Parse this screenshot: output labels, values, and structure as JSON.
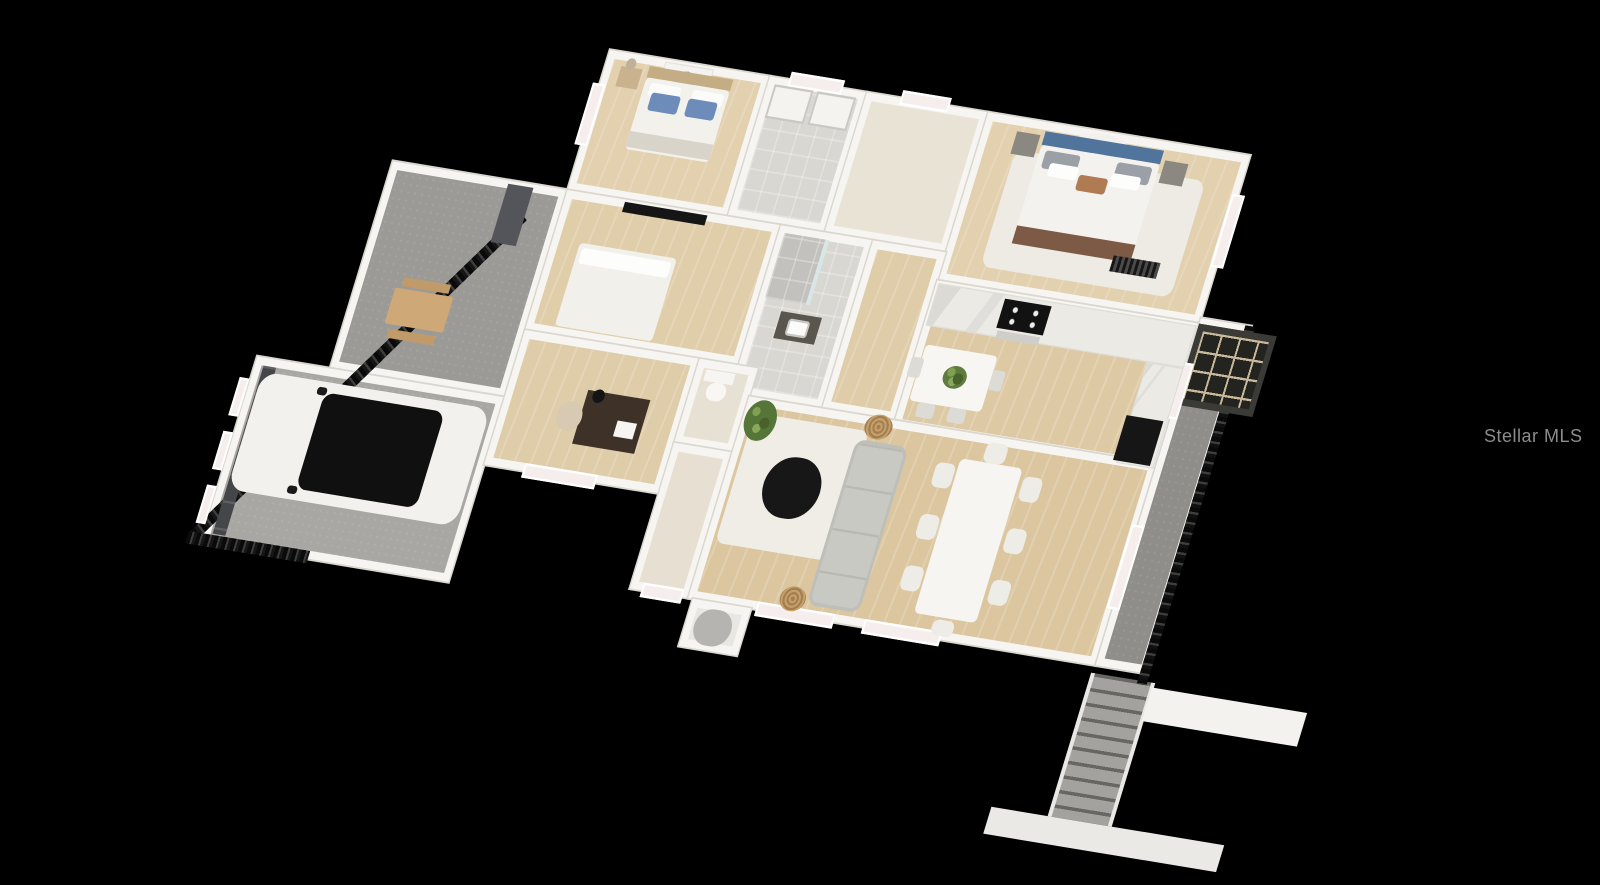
{
  "watermark": {
    "text": "Stellar MLS",
    "color": "#8d8d8d"
  },
  "scene": {
    "background": "#000000",
    "description": "3D dollhouse-view floor plan render of a single-story home",
    "plan": {
      "left": 610,
      "top": 50,
      "transform": "matrix(0.97, 0.16, -0.34, 1.12, 0, 0)"
    }
  },
  "palette": {
    "wall_white": "#f6f5f1",
    "wood_floor": "#ddc9a3",
    "tile_floor": "#d8d7d1",
    "cream_floor": "#e9e3d6",
    "concrete": "#a3a29e",
    "accent_pillow_blue": "#6d8cba",
    "headboard_blue": "#50749c",
    "appliance_black": "#141414",
    "fence_black": "#161616",
    "watermark_gray": "#8d8d8d"
  },
  "boxes": [
    {
      "name": "patio",
      "x": -180,
      "y": 125,
      "w": 180,
      "h": 185,
      "bg": "#9b9a96",
      "cls": "room concrete"
    },
    {
      "name": "garage",
      "x": -255,
      "y": 310,
      "w": 255,
      "h": 165,
      "bg": "#a8a7a3",
      "cls": "room concrete"
    },
    {
      "name": "bedroom-1",
      "x": 0,
      "y": 0,
      "w": 165,
      "h": 125,
      "bg": "#e2d0ae",
      "cls": "room wood"
    },
    {
      "name": "laundry-room",
      "x": 165,
      "y": 0,
      "w": 100,
      "h": 125,
      "bg": "#d8d7d1",
      "cls": "room tilef"
    },
    {
      "name": "closet-hall",
      "x": 265,
      "y": 0,
      "w": 125,
      "h": 125,
      "bg": "#e9e3d6",
      "cls": "room"
    },
    {
      "name": "primary-bedroom",
      "x": 390,
      "y": 0,
      "w": 270,
      "h": 150,
      "bg": "#e2d0ae",
      "cls": "room wood"
    },
    {
      "name": "bedroom-2",
      "x": 0,
      "y": 125,
      "w": 220,
      "h": 125,
      "bg": "#e0cda9",
      "cls": "room wood"
    },
    {
      "name": "bathroom",
      "x": 220,
      "y": 125,
      "w": 95,
      "h": 150,
      "bg": "#d8d7d1",
      "cls": "room tilef"
    },
    {
      "name": "hallway",
      "x": 315,
      "y": 125,
      "w": 75,
      "h": 150,
      "bg": "#dfcca8",
      "cls": "room wood"
    },
    {
      "name": "kitchen",
      "x": 390,
      "y": 150,
      "w": 270,
      "h": 130,
      "bg": "#ddc9a3",
      "cls": "room wood"
    },
    {
      "name": "office",
      "x": 0,
      "y": 250,
      "w": 180,
      "h": 120,
      "bg": "#dfcca8",
      "cls": "room wood"
    },
    {
      "name": "powder-room",
      "x": 180,
      "y": 250,
      "w": 60,
      "h": 75,
      "bg": "#e7e1d4",
      "cls": "room"
    },
    {
      "name": "foyer",
      "x": 180,
      "y": 325,
      "w": 60,
      "h": 130,
      "bg": "#e7e0d2",
      "cls": "room"
    },
    {
      "name": "living-room",
      "x": 240,
      "y": 275,
      "w": 420,
      "h": 180,
      "bg": "#dbc69f",
      "cls": "room wood"
    },
    {
      "name": "entry-porch",
      "x": 245,
      "y": 455,
      "w": 60,
      "h": 42,
      "bg": "#e8e7e2",
      "cls": "room"
    },
    {
      "name": "lanai",
      "x": 660,
      "y": 145,
      "w": 52,
      "h": 310,
      "bg": "#8f8e8a",
      "cls": "room concrete"
    },
    {
      "name": "stair-well",
      "x": 658,
      "y": 462,
      "w": 66,
      "h": 128,
      "bg": "#a3a29e",
      "cls": "stairs"
    },
    {
      "name": "yard-fence",
      "x": -40,
      "y": 150,
      "w": 11,
      "h": 394,
      "rot": 35.7,
      "bg": "#161616",
      "cls": "fence"
    },
    {
      "name": "yard-fence-corner",
      "x": -270,
      "y": 468,
      "w": 125,
      "h": 11,
      "bg": "#161616",
      "cls": "fence-h"
    },
    {
      "name": "patio-column",
      "x": -60,
      "y": 128,
      "w": 26,
      "h": 52,
      "bg": "#54555a"
    },
    {
      "name": "lanai-screen-mesh",
      "x": 706,
      "y": 145,
      "w": 10,
      "h": 320,
      "bg": "#111111",
      "cls": "fence"
    },
    {
      "name": "screen-roof-panel",
      "x": 660,
      "y": 150,
      "w": 80,
      "h": 72,
      "bg": "#23231f",
      "cls": "screen-grid"
    },
    {
      "name": "roof-beam-right",
      "x": 722,
      "y": 466,
      "w": 160,
      "h": 30,
      "bg": "#f3f2ee"
    },
    {
      "name": "roof-beam-lower",
      "x": 600,
      "y": 590,
      "w": 240,
      "h": 24,
      "bg": "#eae9e5"
    },
    {
      "name": "garage-door-panel",
      "x": -246,
      "y": 317,
      "w": 13,
      "h": 150,
      "bg": "#45464a",
      "cls": "panel"
    },
    {
      "name": "window-bedroom1-left",
      "x": -7,
      "y": 30,
      "w": 13,
      "h": 55,
      "bg": "#f6eeec",
      "cls": "window"
    },
    {
      "name": "window-laundry-top",
      "x": 185,
      "y": -7,
      "w": 55,
      "h": 13,
      "bg": "#f6eeec",
      "cls": "window"
    },
    {
      "name": "window-closet-top",
      "x": 300,
      "y": -7,
      "w": 50,
      "h": 13,
      "bg": "#f6eeec",
      "cls": "window"
    },
    {
      "name": "window-primary-right",
      "x": 654,
      "y": 35,
      "w": 13,
      "h": 65,
      "bg": "#f6eeec",
      "cls": "window"
    },
    {
      "name": "window-kitchen-right",
      "x": 654,
      "y": 185,
      "w": 13,
      "h": 50,
      "bg": "#f6eeec",
      "cls": "window"
    },
    {
      "name": "window-living-right",
      "x": 654,
      "y": 330,
      "w": 13,
      "h": 75,
      "bg": "#f6eeec",
      "cls": "window"
    },
    {
      "name": "window-living-bottom-1",
      "x": 310,
      "y": 448,
      "w": 80,
      "h": 13,
      "bg": "#f6eeec",
      "cls": "window"
    },
    {
      "name": "window-living-bottom-2",
      "x": 420,
      "y": 448,
      "w": 80,
      "h": 13,
      "bg": "#f6eeec",
      "cls": "window"
    },
    {
      "name": "window-office-bottom",
      "x": 40,
      "y": 363,
      "w": 75,
      "h": 13,
      "bg": "#f6eeec",
      "cls": "window"
    },
    {
      "name": "window-foyer-bottom",
      "x": 192,
      "y": 448,
      "w": 42,
      "h": 13,
      "bg": "#f6eeec",
      "cls": "window"
    },
    {
      "name": "window-garage-1",
      "x": -266,
      "y": 330,
      "w": 10,
      "h": 34,
      "bg": "#f6eeec",
      "cls": "window"
    },
    {
      "name": "window-garage-2",
      "x": -266,
      "y": 378,
      "w": 10,
      "h": 34,
      "bg": "#f6eeec",
      "cls": "window"
    },
    {
      "name": "window-garage-3",
      "x": -266,
      "y": 426,
      "w": 10,
      "h": 34,
      "bg": "#f6eeec",
      "cls": "window"
    },
    {
      "name": "bedroom1-wall-art",
      "x": 58,
      "y": 2,
      "w": 50,
      "h": 30,
      "bg": "#f4f3ef",
      "cls": "art-blue"
    },
    {
      "name": "bedroom1-nightstand",
      "x": 16,
      "y": 12,
      "w": 22,
      "h": 18,
      "bg": "#c9b28d"
    },
    {
      "name": "bedroom1-lamp",
      "x": 20,
      "y": 4,
      "w": 10,
      "h": 10,
      "bg": "#c0b096",
      "r": 5
    },
    {
      "name": "bedroom1-headboard",
      "x": 44,
      "y": 8,
      "w": 86,
      "h": 10,
      "bg": "#c4ad85"
    },
    {
      "name": "bedroom1-bed",
      "x": 44,
      "y": 18,
      "w": 86,
      "h": 64,
      "bg": "#f3f1eb",
      "r": 4
    },
    {
      "name": "bedroom1-pillow-white-left",
      "x": 50,
      "y": 22,
      "w": 32,
      "h": 12,
      "bg": "#fbfbf9",
      "r": 3
    },
    {
      "name": "bedroom1-pillow-white-right",
      "x": 94,
      "y": 22,
      "w": 32,
      "h": 12,
      "bg": "#fbfbf9",
      "r": 3
    },
    {
      "name": "bedroom1-pillow-blue-left",
      "x": 54,
      "y": 30,
      "w": 30,
      "h": 16,
      "bg": "#6d8cba",
      "r": 3
    },
    {
      "name": "bedroom1-pillow-blue-right",
      "x": 92,
      "y": 30,
      "w": 30,
      "h": 16,
      "bg": "#6d8cba",
      "r": 3
    },
    {
      "name": "bedroom1-foot-throw",
      "x": 44,
      "y": 66,
      "w": 86,
      "h": 14,
      "bg": "#d9d4c9"
    },
    {
      "name": "laundry-washer",
      "x": 172,
      "y": 6,
      "w": 40,
      "h": 30,
      "bg": "#f4f3ef",
      "cls": "appliance"
    },
    {
      "name": "laundry-dryer",
      "x": 216,
      "y": 6,
      "w": 40,
      "h": 30,
      "bg": "#f4f3ef",
      "cls": "appliance"
    },
    {
      "name": "primary-wall-art",
      "x": 478,
      "y": 2,
      "w": 66,
      "h": 34,
      "bg": "#f2f1ee",
      "cls": "art-abstract"
    },
    {
      "name": "primary-rug",
      "x": 428,
      "y": 28,
      "w": 196,
      "h": 104,
      "bg": "#edebe3",
      "r": 10
    },
    {
      "name": "primary-headboard",
      "x": 452,
      "y": 8,
      "w": 122,
      "h": 12,
      "bg": "#50749c"
    },
    {
      "name": "primary-bed",
      "x": 452,
      "y": 20,
      "w": 122,
      "h": 88,
      "bg": "#f4f2ee",
      "r": 4
    },
    {
      "name": "primary-pillow-gray-left",
      "x": 458,
      "y": 24,
      "w": 36,
      "h": 16,
      "bg": "#9aa0a6",
      "r": 3
    },
    {
      "name": "primary-pillow-gray-right",
      "x": 532,
      "y": 24,
      "w": 36,
      "h": 16,
      "bg": "#9aa0a6",
      "r": 3
    },
    {
      "name": "primary-pillow-white-left",
      "x": 466,
      "y": 34,
      "w": 30,
      "h": 12,
      "bg": "#fdfdfb",
      "r": 3
    },
    {
      "name": "primary-pillow-white-right",
      "x": 530,
      "y": 34,
      "w": 30,
      "h": 12,
      "bg": "#fdfdfb",
      "r": 3
    },
    {
      "name": "primary-pillow-accent",
      "x": 498,
      "y": 40,
      "w": 30,
      "h": 14,
      "bg": "#b07a52",
      "r": 3
    },
    {
      "name": "primary-foot-blanket",
      "x": 452,
      "y": 92,
      "w": 122,
      "h": 16,
      "bg": "#7d5a45"
    },
    {
      "name": "primary-nightstand-left",
      "x": 424,
      "y": 12,
      "w": 24,
      "h": 20,
      "bg": "#8a8880"
    },
    {
      "name": "primary-nightstand-right",
      "x": 578,
      "y": 16,
      "w": 24,
      "h": 20,
      "bg": "#8a8880"
    },
    {
      "name": "primary-bench",
      "x": 556,
      "y": 104,
      "w": 48,
      "h": 14,
      "bg": "#2e2e2e",
      "cls": "radiator"
    },
    {
      "name": "bedroom2-tv",
      "x": 60,
      "y": 127,
      "w": 85,
      "h": 9,
      "bg": "#151515"
    },
    {
      "name": "bedroom2-bed",
      "x": 28,
      "y": 168,
      "w": 100,
      "h": 74,
      "bg": "#f2f0ea",
      "r": 4
    },
    {
      "name": "bedroom2-pillow",
      "x": 32,
      "y": 172,
      "w": 92,
      "h": 14,
      "bg": "#fdfdfb",
      "r": 3
    },
    {
      "name": "bathroom-shower",
      "x": 226,
      "y": 131,
      "w": 42,
      "h": 58,
      "bg": "#c2c1bd",
      "cls": "tilef"
    },
    {
      "name": "bathroom-shower-glass",
      "x": 268,
      "y": 131,
      "w": 4,
      "h": 58,
      "bg": "#d9e6e8"
    },
    {
      "name": "bathroom-vanity",
      "x": 246,
      "y": 198,
      "w": 42,
      "h": 24,
      "bg": "#5a554d"
    },
    {
      "name": "bathroom-sink",
      "x": 256,
      "y": 203,
      "w": 22,
      "h": 15,
      "bg": "#fbfbf9",
      "r": 3,
      "cls": "appliance"
    },
    {
      "name": "powder-toilet-tank",
      "x": 190,
      "y": 258,
      "w": 30,
      "h": 10,
      "bg": "#f6f5f1"
    },
    {
      "name": "powder-toilet-bowl",
      "x": 196,
      "y": 268,
      "w": 20,
      "h": 16,
      "bg": "#f8f7f3",
      "r": 9
    },
    {
      "name": "office-desk",
      "x": 80,
      "y": 292,
      "w": 64,
      "h": 48,
      "bg": "#3d3128"
    },
    {
      "name": "office-lamp",
      "x": 86,
      "y": 290,
      "w": 12,
      "h": 12,
      "bg": "#141414",
      "r": 6
    },
    {
      "name": "office-papers",
      "x": 118,
      "y": 314,
      "w": 20,
      "h": 14,
      "bg": "#f6f5f1"
    },
    {
      "name": "office-chair",
      "x": 56,
      "y": 304,
      "w": 26,
      "h": 26,
      "bg": "#d8cab2",
      "r": 13
    },
    {
      "name": "kitchen-counter-top",
      "x": 392,
      "y": 152,
      "w": 266,
      "h": 38,
      "bg": "#eceae5",
      "cls": "counter"
    },
    {
      "name": "kitchen-cooktop",
      "x": 462,
      "y": 156,
      "w": 48,
      "h": 26,
      "bg": "#121212",
      "cls": "cooktop"
    },
    {
      "name": "kitchen-oven",
      "x": 464,
      "y": 184,
      "w": 44,
      "h": 7,
      "bg": "#cfcecb"
    },
    {
      "name": "kitchen-counter-right",
      "x": 620,
      "y": 190,
      "w": 38,
      "h": 90,
      "bg": "#eceae5",
      "cls": "counter"
    },
    {
      "name": "kitchen-fridge",
      "x": 616,
      "y": 238,
      "w": 38,
      "h": 40,
      "bg": "#161616"
    },
    {
      "name": "breakfast-table",
      "x": 398,
      "y": 206,
      "w": 74,
      "h": 50,
      "bg": "#f7f6f2",
      "r": 4
    },
    {
      "name": "breakfast-plant",
      "x": 424,
      "y": 220,
      "w": 24,
      "h": 20,
      "bg": "#5d7c3e",
      "cls": "plant"
    },
    {
      "name": "breakfast-chair-left",
      "x": 388,
      "y": 218,
      "w": 13,
      "h": 18,
      "bg": "#dcdbd6",
      "r": 3
    },
    {
      "name": "breakfast-chair-right",
      "x": 472,
      "y": 218,
      "w": 13,
      "h": 18,
      "bg": "#dcdbd6",
      "r": 3
    },
    {
      "name": "breakfast-chair-bottom-1",
      "x": 408,
      "y": 256,
      "w": 18,
      "h": 13,
      "bg": "#dcdbd6",
      "r": 3
    },
    {
      "name": "breakfast-chair-bottom-2",
      "x": 440,
      "y": 256,
      "w": 18,
      "h": 13,
      "bg": "#dcdbd6",
      "r": 3
    },
    {
      "name": "living-rug",
      "x": 250,
      "y": 288,
      "w": 118,
      "h": 116,
      "bg": "#efede6",
      "r": 8
    },
    {
      "name": "living-plant",
      "x": 242,
      "y": 276,
      "w": 32,
      "h": 36,
      "bg": "#567539",
      "cls": "plant"
    },
    {
      "name": "coffee-table",
      "x": 280,
      "y": 320,
      "w": 58,
      "h": 54,
      "bg": "#171717",
      "r": 29
    },
    {
      "name": "sofa",
      "x": 358,
      "y": 296,
      "w": 54,
      "h": 148,
      "bg": "#c9c9c3",
      "cls": "sofa"
    },
    {
      "name": "wicker-table-top",
      "x": 362,
      "y": 272,
      "w": 28,
      "h": 22,
      "bg": "#c6a06c",
      "cls": "wicker"
    },
    {
      "name": "wicker-table-bottom",
      "x": 330,
      "y": 430,
      "w": 26,
      "h": 22,
      "bg": "#c6a06c",
      "cls": "wicker"
    },
    {
      "name": "dining-table",
      "x": 466,
      "y": 298,
      "w": 64,
      "h": 138,
      "bg": "#f6f5f1",
      "r": 5
    },
    {
      "name": "dining-chair-left-1",
      "x": 444,
      "y": 304,
      "w": 20,
      "h": 22,
      "bg": "#edece6",
      "r": 6
    },
    {
      "name": "dining-chair-left-2",
      "x": 444,
      "y": 350,
      "w": 20,
      "h": 22,
      "bg": "#edece6",
      "r": 6
    },
    {
      "name": "dining-chair-left-3",
      "x": 444,
      "y": 396,
      "w": 20,
      "h": 22,
      "bg": "#edece6",
      "r": 6
    },
    {
      "name": "dining-chair-right-1",
      "x": 534,
      "y": 304,
      "w": 20,
      "h": 22,
      "bg": "#edece6",
      "r": 6
    },
    {
      "name": "dining-chair-right-2",
      "x": 534,
      "y": 350,
      "w": 20,
      "h": 22,
      "bg": "#edece6",
      "r": 6
    },
    {
      "name": "dining-chair-right-3",
      "x": 534,
      "y": 396,
      "w": 20,
      "h": 22,
      "bg": "#edece6",
      "r": 6
    },
    {
      "name": "dining-chair-top",
      "x": 488,
      "y": 280,
      "w": 22,
      "h": 18,
      "bg": "#edece6",
      "r": 6
    },
    {
      "name": "dining-chair-bottom",
      "x": 488,
      "y": 438,
      "w": 22,
      "h": 14,
      "bg": "#edece6",
      "r": 6
    },
    {
      "name": "entry-column",
      "x": 254,
      "y": 461,
      "w": 38,
      "h": 32,
      "bg": "#b5b4b0",
      "r": 19
    },
    {
      "name": "car-body",
      "x": -245,
      "y": 322,
      "w": 235,
      "h": 105,
      "bg": "#f2f1ed",
      "r": 16
    },
    {
      "name": "car-roof",
      "x": -178,
      "y": 331,
      "w": 124,
      "h": 86,
      "bg": "#101010",
      "r": 10
    },
    {
      "name": "car-mirror-top",
      "x": -186,
      "y": 327,
      "w": 10,
      "h": 7,
      "bg": "#1a1a1a",
      "r": 3
    },
    {
      "name": "car-mirror-bottom",
      "x": -186,
      "y": 415,
      "w": 10,
      "h": 7,
      "bg": "#1a1a1a",
      "r": 3
    },
    {
      "name": "picnic-table",
      "x": -140,
      "y": 232,
      "w": 60,
      "h": 32,
      "bg": "#cfa877",
      "r": 2
    },
    {
      "name": "picnic-bench-top",
      "x": -134,
      "y": 222,
      "w": 48,
      "h": 8,
      "bg": "#c09a68"
    },
    {
      "name": "picnic-bench-bottom",
      "x": -134,
      "y": 268,
      "w": 48,
      "h": 8,
      "bg": "#c09a68"
    }
  ]
}
